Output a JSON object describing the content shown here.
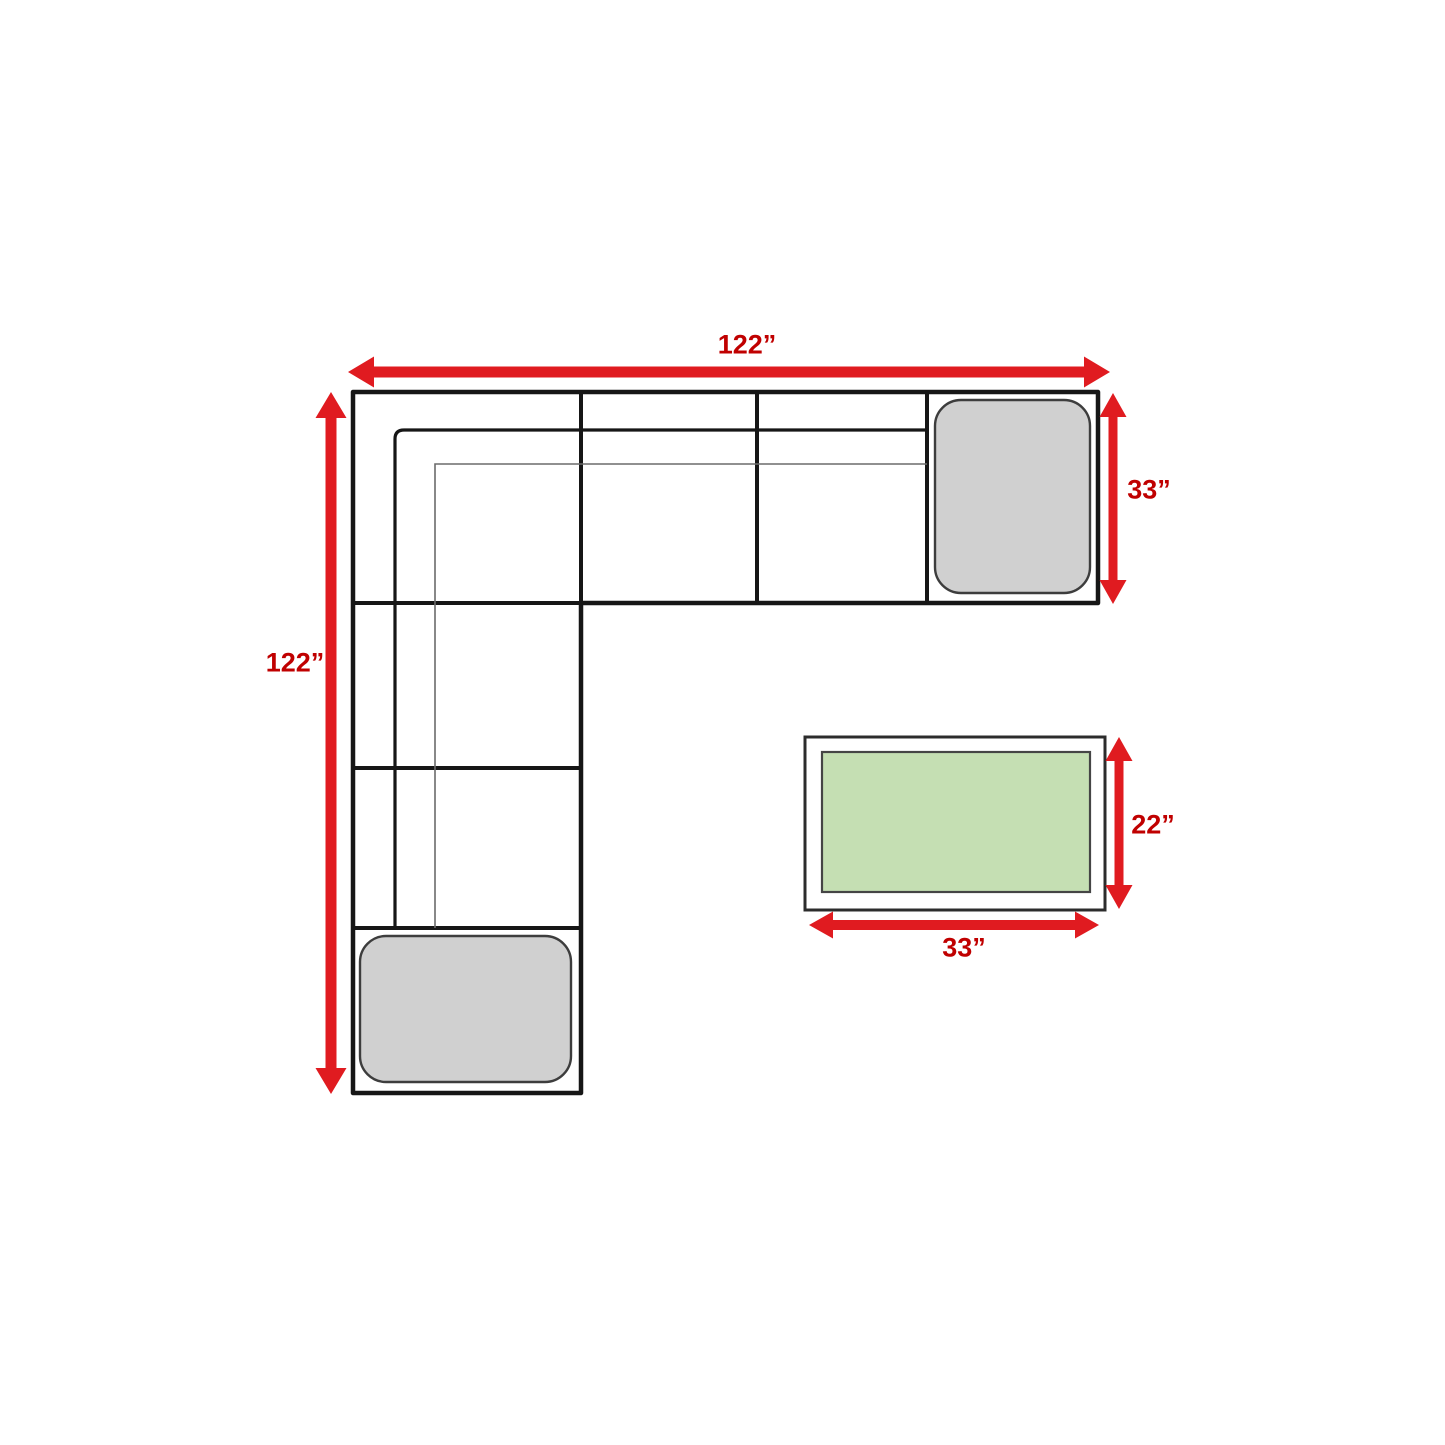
{
  "diagram": {
    "kind": "sectional-sofa-dimension-diagram",
    "sectional": {
      "width_label": "122”",
      "height_label": "122”",
      "corner_depth_label": "33”"
    },
    "coffee_table": {
      "depth_label": "22”",
      "width_label": "33”"
    },
    "colors": {
      "arrow": "#e01b20",
      "label": "#c00000",
      "outline": "#161616",
      "thin_line": "#6b6b6b",
      "ottoman_fill": "#d0d0d0",
      "ottoman_stroke": "#3d3d3d",
      "table_stroke": "#2c2c2c",
      "table_top_fill": "#c5dfb3",
      "table_top_stroke": "#454545"
    }
  }
}
